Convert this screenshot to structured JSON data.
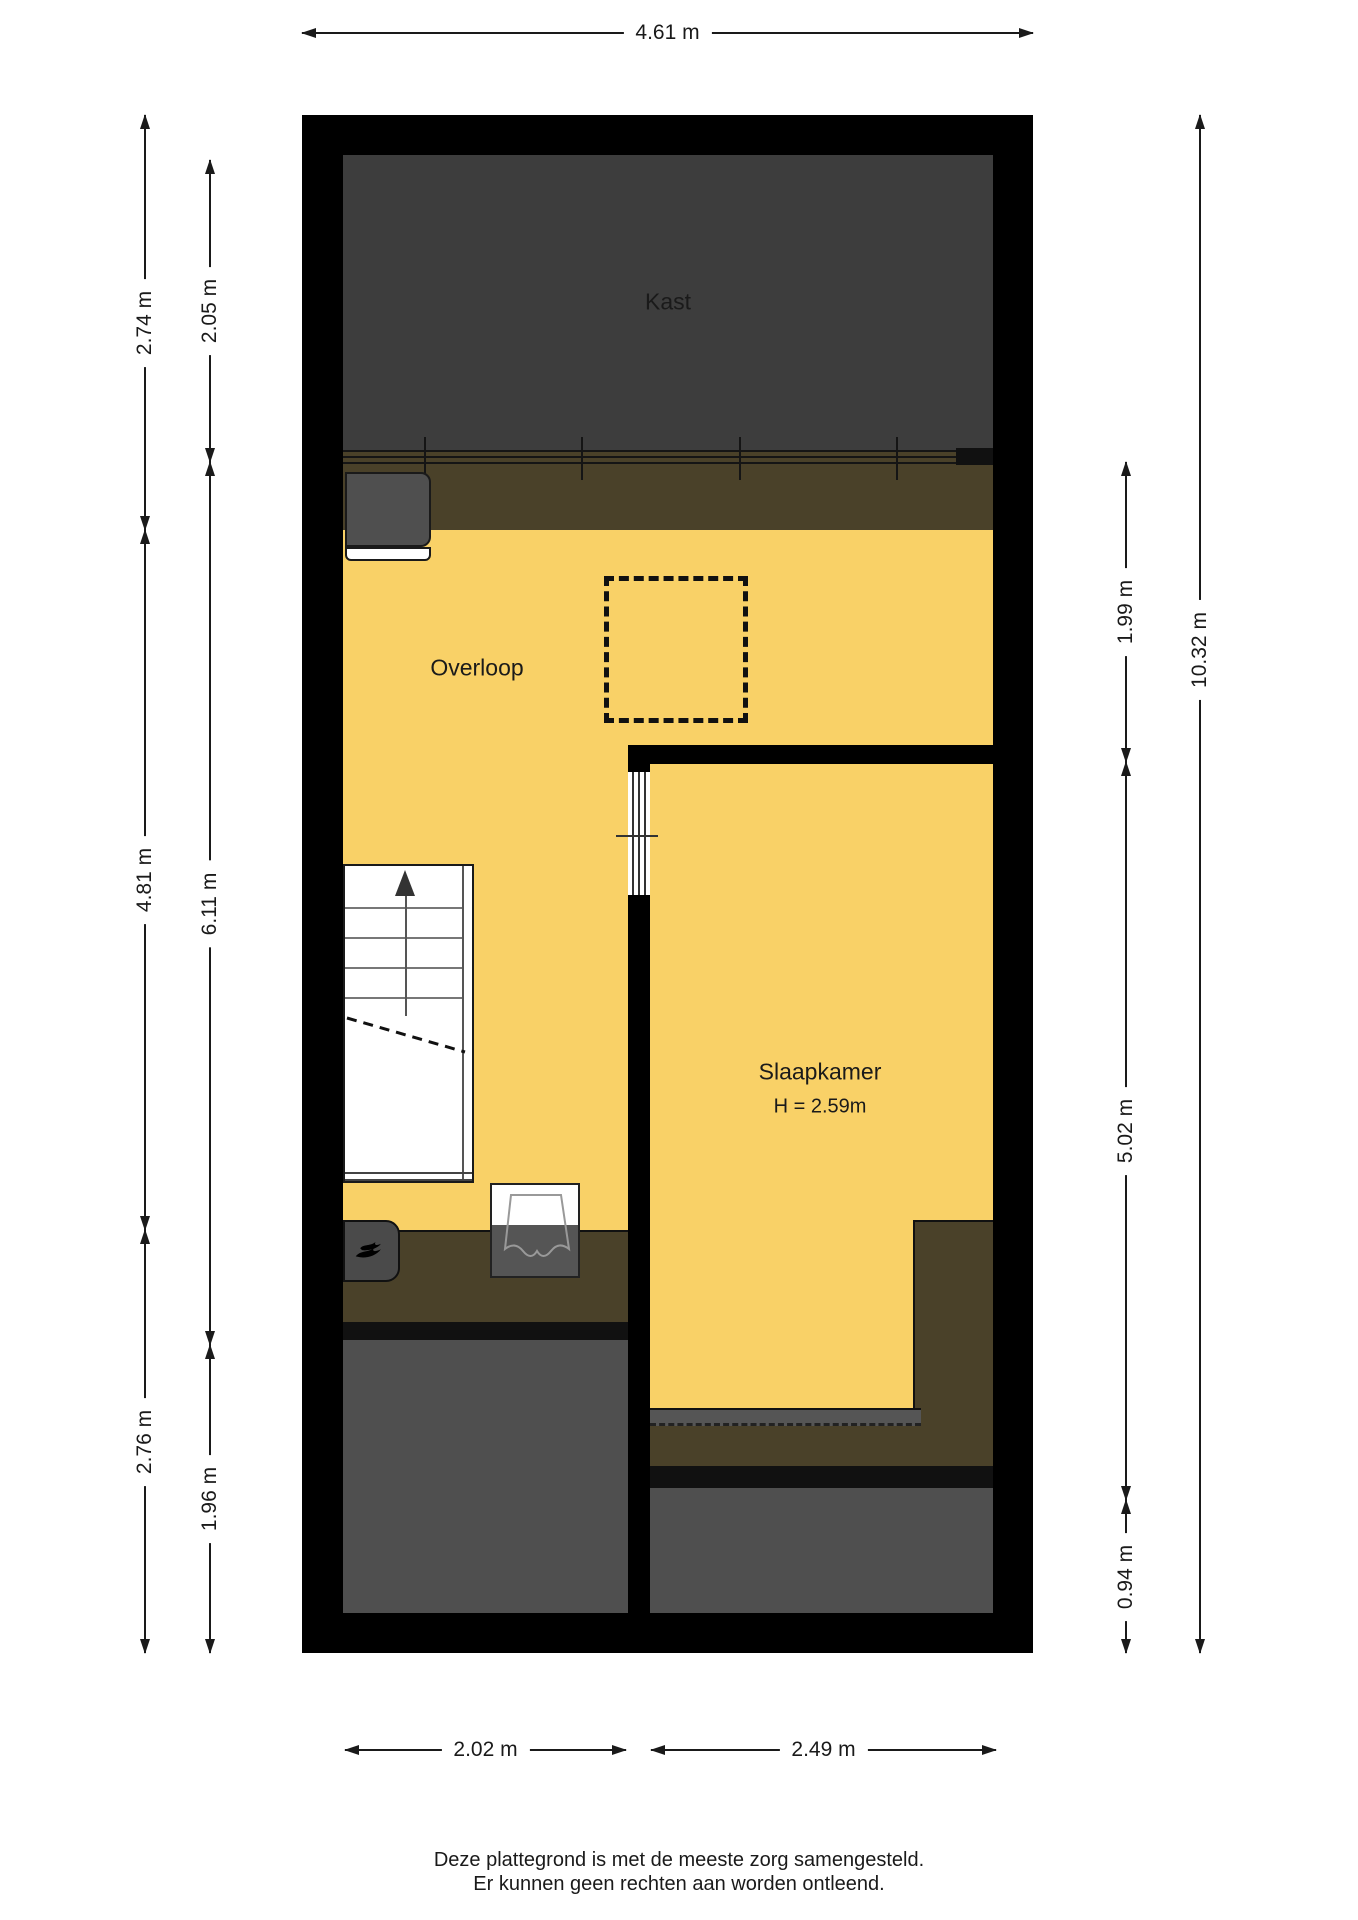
{
  "plan": {
    "rooms": {
      "kast": "Kast",
      "overloop": "Overloop",
      "slaapkamer": "Slaapkamer",
      "slaapkamer_height": "H = 2.59m"
    },
    "dimensions": {
      "top": "4.61 m",
      "bottom_left": "2.02 m",
      "bottom_right": "2.49 m",
      "left_outer": [
        "2.74 m",
        "4.81 m",
        "2.76 m"
      ],
      "left_inner": [
        "2.05 m",
        "6.11 m",
        "1.96 m"
      ],
      "right_inner": [
        "1.99 m",
        "5.02 m",
        "0.94 m"
      ],
      "right_outer": "10.32 m"
    },
    "colors": {
      "floor_yellow": "#f9d167",
      "closet_dark_gray": "#3d3d3d",
      "knee_wall_olive": "#4a4129",
      "attic_room_gray": "#4f4f4f",
      "wall_black": "#000000"
    },
    "icons": {
      "stairs_direction": "up-arrow-icon",
      "boiler_logo": "flame-icon",
      "sink_symbol": "basin-icon"
    }
  },
  "footer": {
    "line1": "Deze plattegrond is met de meeste zorg samengesteld.",
    "line2": "Er kunnen geen rechten aan worden ontleend."
  }
}
